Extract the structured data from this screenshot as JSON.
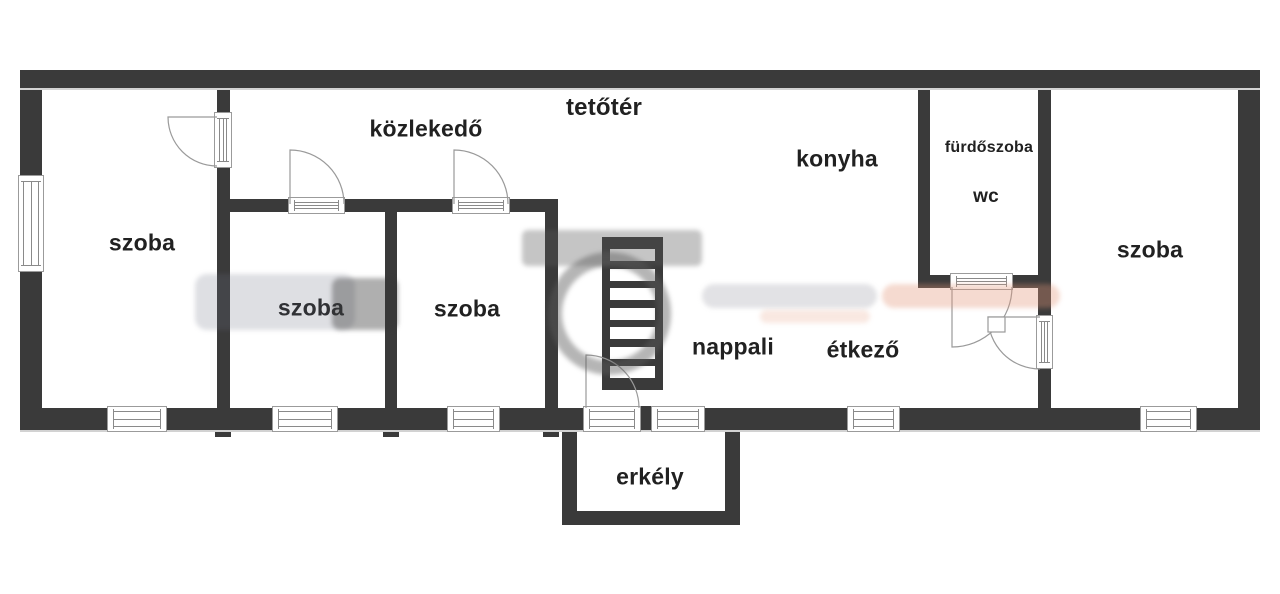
{
  "plan_title": "floor plan",
  "rooms": [
    {
      "id": "tetoter",
      "label": "tetőtér"
    },
    {
      "id": "kozlekedo",
      "label": "közlekedő"
    },
    {
      "id": "konyha",
      "label": "konyha"
    },
    {
      "id": "furdoszoba",
      "label": "fürdőszoba"
    },
    {
      "id": "wc",
      "label": "wc"
    },
    {
      "id": "szoba-left",
      "label": "szoba"
    },
    {
      "id": "szoba-mid-1",
      "label": "szoba"
    },
    {
      "id": "szoba-mid-2",
      "label": "szoba"
    },
    {
      "id": "nappali",
      "label": "nappali"
    },
    {
      "id": "etkezo",
      "label": "étkező"
    },
    {
      "id": "szoba-right",
      "label": "szoba"
    },
    {
      "id": "erkely",
      "label": "erkély"
    }
  ],
  "stairs": {
    "treads": 7
  },
  "colors": {
    "wall": "#3a3a3a",
    "window_line": "#8a8a8a",
    "frame_outline": "#9b9b9b",
    "text": "#212121",
    "watermark_gray": "#5a5a5a",
    "watermark_salmon": "#e29478"
  }
}
